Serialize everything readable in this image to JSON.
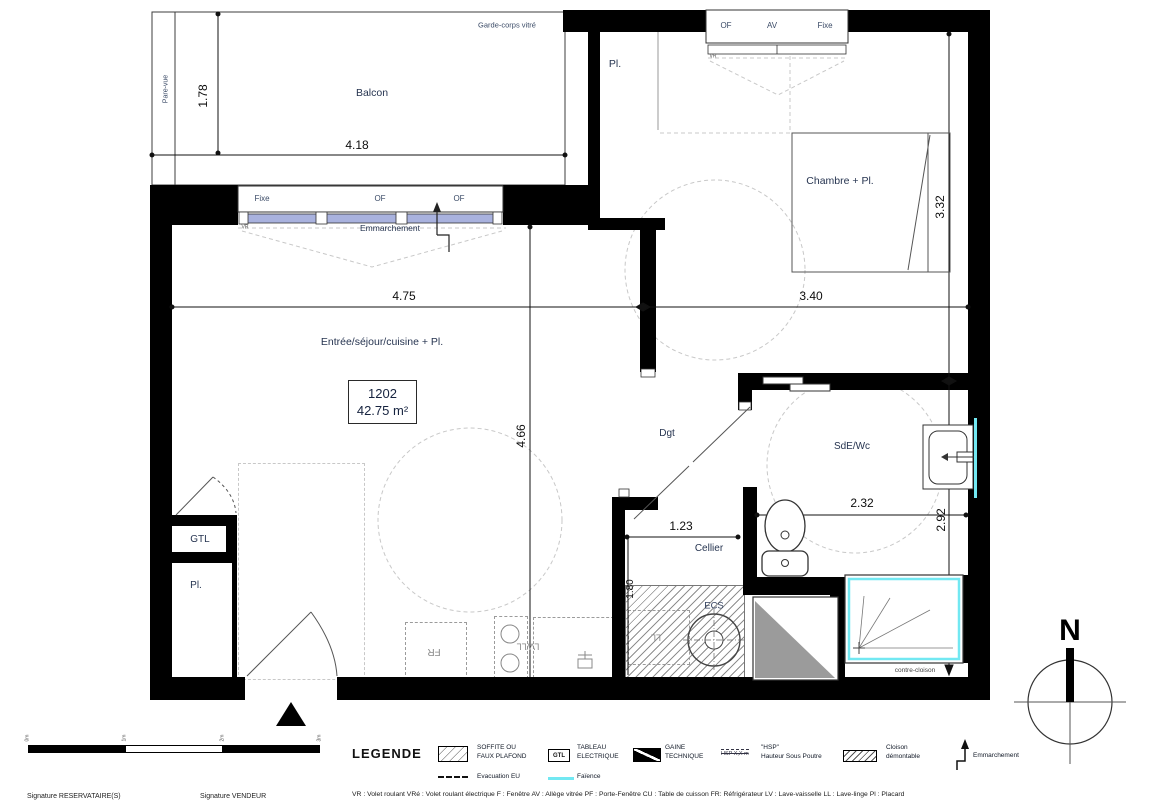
{
  "colors": {
    "wall": "#000000",
    "faience_cyan": "#72e8f2",
    "window_glass_blue": "#a9b2de",
    "duct_gray": "#9b9b9b",
    "hatch_gray": "#8f8f8f"
  },
  "plan": {
    "balcony": {
      "label": "Balcon",
      "width_dim": "4.18",
      "depth_dim": "1.78",
      "railing_note": "Garde-corps vitré",
      "screen_note": "Pare-vue"
    },
    "windows": {
      "living": {
        "panes": [
          "Fixe",
          "OF",
          "OF"
        ],
        "shutter": "VR",
        "step_note": "Emmarchement"
      },
      "bedroom": {
        "panes": [
          "OF",
          "AV",
          "Fixe"
        ],
        "shutter": "VR"
      }
    },
    "rooms": {
      "living": {
        "label": "Entrée/séjour/cuisine + Pl.",
        "width_dim": "4.75",
        "height_dim": "4.66"
      },
      "bedroom": {
        "label": "Chambre + Pl.",
        "width_dim": "3.40",
        "height_dim": "3.32"
      },
      "bathroom": {
        "label": "SdE/Wc",
        "width_dim": "2.32",
        "height_dim": "2.92"
      },
      "cellar": {
        "label": "Cellier",
        "width_dim": "1.23",
        "height_dim": "1.80"
      },
      "hallway": {
        "label": "Dgt"
      },
      "closet_top": {
        "label": "Pl."
      },
      "closet_left": {
        "label": "Pl."
      },
      "gtl_closet": {
        "label": "GTL"
      }
    },
    "unit": {
      "number": "1202",
      "area": "42.75 m²"
    },
    "equipment": {
      "water_heater": "ECS",
      "fridge": "FR",
      "washer_dishwasher": "LV/LL",
      "washer": "LL",
      "counter_wall_note": "contre-cloison"
    },
    "compass": {
      "north": "N"
    },
    "scale_bar": {
      "ticks": [
        "0m",
        "1m",
        "2m",
        "3m"
      ]
    }
  },
  "legend": {
    "title": "LEGENDE",
    "items": [
      {
        "line1": "SOFFITE OU",
        "line2": "FAUX PLAFOND"
      },
      {
        "swatch_text": "GTL",
        "line1": "TABLEAU",
        "line2": "ELECTRIQUE"
      },
      {
        "line1": "GAINE",
        "line2": "TECHNIQUE"
      },
      {
        "symbol_text": "HSP X,X m",
        "line1": "\"HSP\"",
        "line2": "Hauteur Sous Poutre"
      },
      {
        "line1": "Cloison",
        "line2": "démontable"
      },
      {
        "line1": "Emmarchement",
        "line2": ""
      },
      {
        "line1": "Evacuation EU",
        "line2": ""
      },
      {
        "line1": "Faïence",
        "line2": ""
      }
    ],
    "abbreviations": "VR : Volet roulant   VRé : Volet roulant électrique   F : Fenêtre   AV : Allège vitrée   PF : Porte-Fenêtre   CU : Table de cuisson   FR: Réfrigérateur   LV : Lave-vaisselle   LL : Lave-linge   Pl : Placard"
  },
  "footer": {
    "signature_left": "Signature RESERVATAIRE(S)",
    "signature_right": "Signature VENDEUR"
  }
}
